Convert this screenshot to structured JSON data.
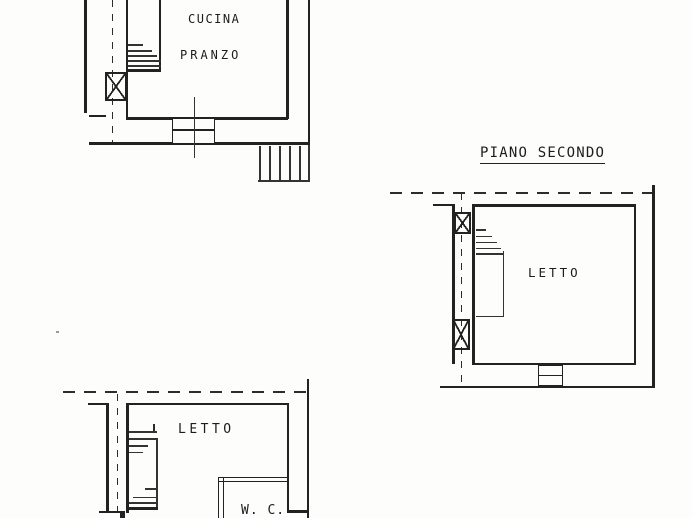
{
  "sheet": {
    "background_color": "#fdfdfc",
    "ink_color": "#222222",
    "plans": {
      "kitchen_floor": {
        "room_label_line1": "CUCINA",
        "room_label_line2": "PRANZO"
      },
      "second_floor": {
        "title": "PIANO SECONDO",
        "room_label": "LETTO"
      },
      "bedroom_floor": {
        "room_label": "LETTO",
        "wc_label": "W. C."
      }
    }
  }
}
